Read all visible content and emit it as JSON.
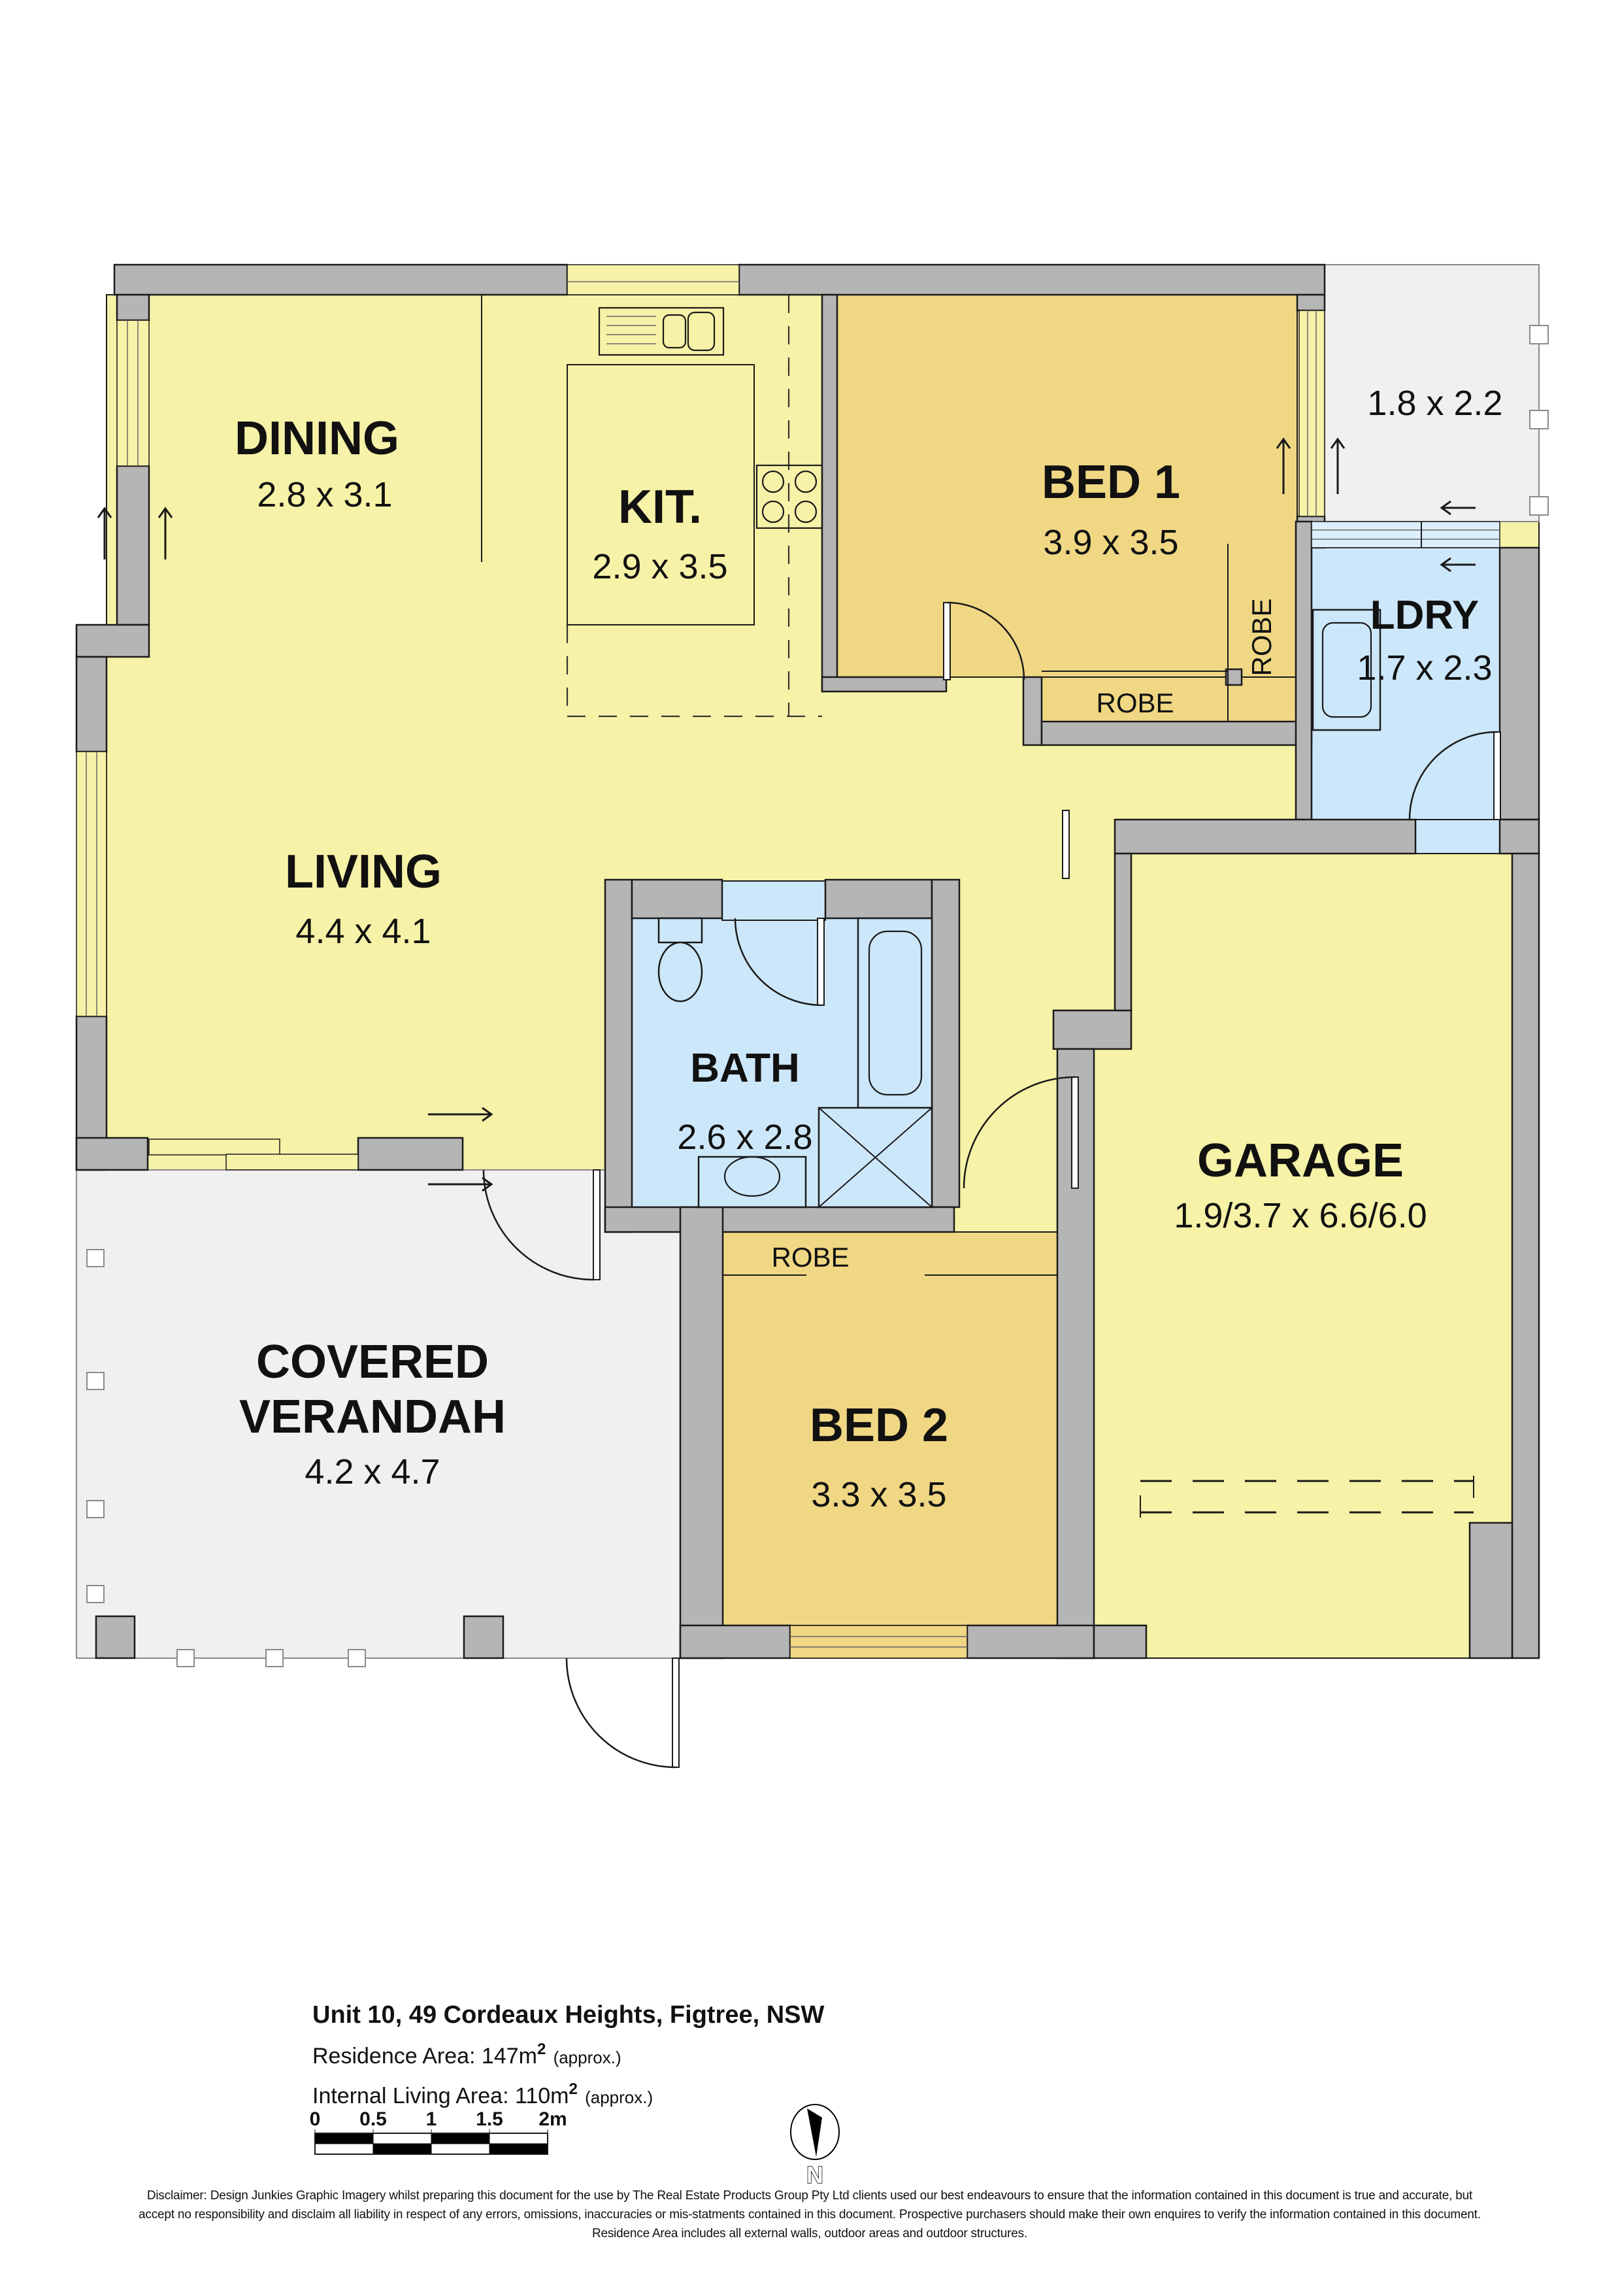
{
  "colors": {
    "wall": "#b5b5b5",
    "floor_yellow": "#f6f2a7",
    "floor_tan": "#f0d784",
    "floor_blue": "#cde7fa",
    "glass_blue": "#dbeffc",
    "porch_gray": "#f0f0f0"
  },
  "rooms": {
    "dining": {
      "name": "DINING",
      "dims": "2.8 x 3.1"
    },
    "kitchen": {
      "name": "KIT.",
      "dims": "2.9 x 3.5"
    },
    "living": {
      "name": "LIVING",
      "dims": "4.4 x 4.1"
    },
    "bed1": {
      "name": "BED 1",
      "dims": "3.9 x 3.5"
    },
    "bed2": {
      "name": "BED 2",
      "dims": "3.3 x 3.5"
    },
    "bath": {
      "name": "BATH",
      "dims": "2.6 x 2.8"
    },
    "laundry": {
      "name": "LDRY",
      "dims": "1.7 x 2.3"
    },
    "garage": {
      "name": "GARAGE",
      "dims": "1.9/3.7 x 6.6/6.0"
    },
    "verandah": {
      "name_line1": "COVERED",
      "name_line2": "VERANDAH",
      "dims": "4.2 x 4.7"
    },
    "porch": {
      "dims": "1.8 x 2.2"
    }
  },
  "labels": {
    "robe": "ROBE"
  },
  "footer": {
    "address": "Unit 10, 49 Cordeaux Heights, Figtree, NSW",
    "residence_area": {
      "label": "Residence Area: 147m",
      "sup": "2",
      "suffix": " (approx.)"
    },
    "internal_area": {
      "label": "Internal Living Area: 110m",
      "sup": "2",
      "suffix": " (approx.)"
    },
    "scale": {
      "ticks": [
        "0",
        "0.5",
        "1",
        "1.5",
        "2m"
      ]
    },
    "compass_label": "N",
    "disclaimer": [
      "Disclaimer: Design Junkies Graphic Imagery whilst preparing this document for the use by The Real Estate Products Group Pty Ltd clients used our best endeavours to ensure that the information contained in this document is true and accurate, but",
      "accept no responsibility and disclaim all liability in respect of any errors, omissions, inaccuracies or mis-statments contained in this document. Prospective purchasers should make their own enquires to verify the information contained in this document.",
      "Residence Area includes all external walls, outdoor areas and outdoor structures."
    ]
  }
}
